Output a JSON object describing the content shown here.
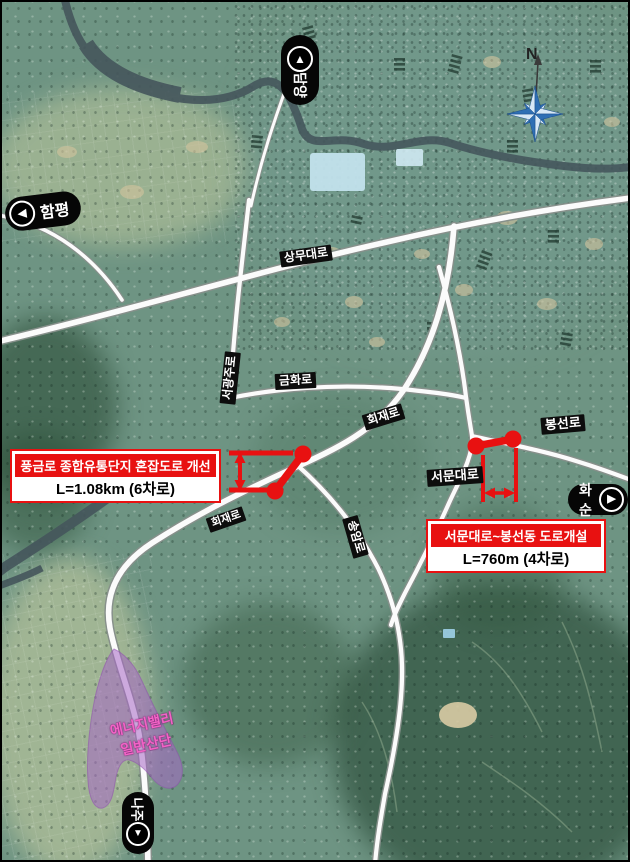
{
  "map": {
    "compass": {
      "north_label": "N"
    },
    "arrows": {
      "up": "▲",
      "left": "◀",
      "right": "▶",
      "down": "▼"
    },
    "directions": {
      "damyang": "담양",
      "hampyeong": "함평",
      "hwasun": "화순",
      "naju": "나주"
    },
    "roads": {
      "sangmu": "상무대로",
      "seogwangju": "서광주로",
      "geumhwa": "금화로",
      "hoejae_upper": "회재로",
      "hoejae_lower": "회재로",
      "seomun": "서문대로",
      "bongseon": "봉선로",
      "songam": "송암로"
    },
    "projects": {
      "punggeum": {
        "title": "풍금로 종합유통단지 혼잡도로 개선",
        "detail": "L=1.08km (6차로)"
      },
      "seomun_bongseon": {
        "title": "서문대로~봉선동 도로개설",
        "detail": "L=760m (4차로)"
      }
    },
    "area": {
      "line1": "에너지밸리",
      "line2": "일반산단"
    },
    "colors": {
      "annotation_red": "#e81111",
      "compass_blue": "#2f6fb4",
      "industrial_purple": "#a566c4",
      "water_dark": "#45565c"
    }
  }
}
